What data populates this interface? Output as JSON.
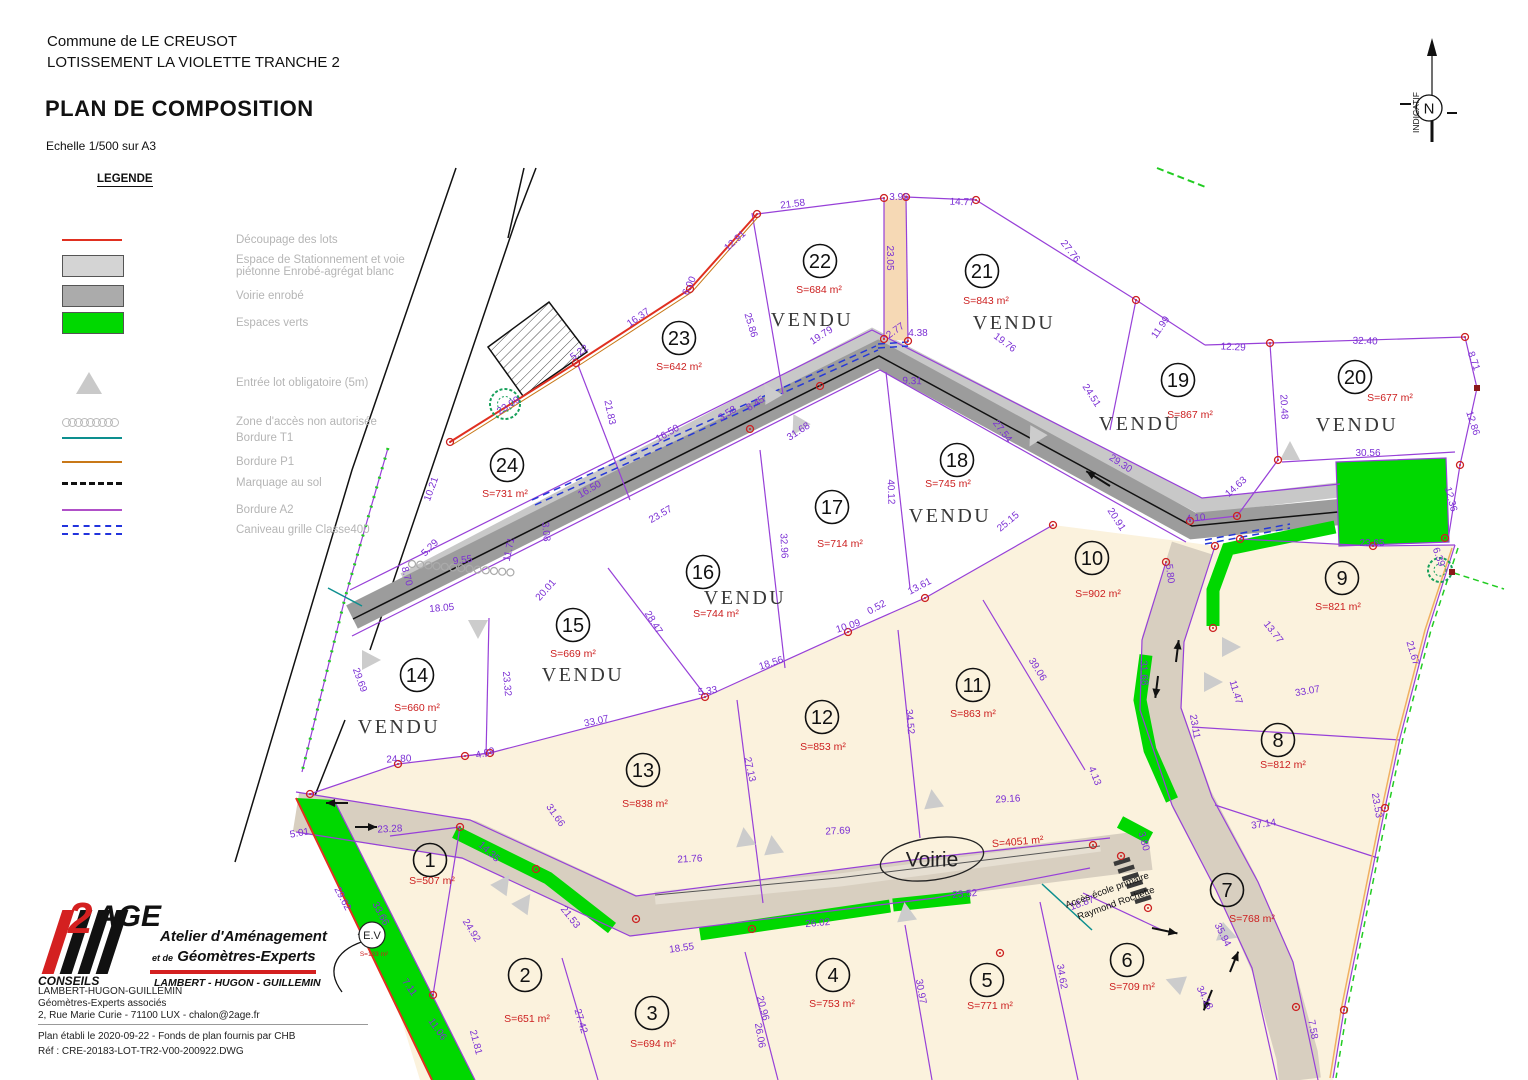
{
  "header": {
    "commune": "Commune de LE CREUSOT",
    "lotissement": "LOTISSEMENT LA VIOLETTE TRANCHE 2",
    "title": "PLAN DE COMPOSITION",
    "scale": "Echelle 1/500 sur A3"
  },
  "north": {
    "label": "INDICATIF",
    "n": "N"
  },
  "legend": {
    "title": "LEGENDE",
    "items": [
      {
        "type": "line-red",
        "color": "#e03020",
        "label": "Découpage des lots"
      },
      {
        "type": "box-light",
        "color": "#d4d4d4",
        "label": "Espace de Stationnement et voie",
        "label2": "piétonne Enrobé-agrégat blanc"
      },
      {
        "type": "box-gray",
        "color": "#ababab",
        "label": "Voirie enrobé"
      },
      {
        "type": "box-green",
        "color": "#00d800",
        "label": "Espaces verts"
      },
      {
        "type": "triangle",
        "color": "#c9c9c9",
        "label": "Entrée lot obligatoire (5m)"
      },
      {
        "type": "chain",
        "color": "#b9b9b9",
        "label": "Zone d'accès non autorisée"
      },
      {
        "type": "line-teal",
        "color": "#0d8f8f",
        "label": "Bordure T1"
      },
      {
        "type": "line-orange",
        "color": "#c87818",
        "label": "Bordure P1"
      },
      {
        "type": "dash-black",
        "color": "#111111",
        "label": "Marquage au sol"
      },
      {
        "type": "line-purple",
        "color": "#b050c8",
        "label": "Bordure A2"
      },
      {
        "type": "dash-blue",
        "color": "#2233dd",
        "label": "Caniveau grille Classe400"
      }
    ]
  },
  "map": {
    "lots": [
      {
        "num": "1",
        "area": "S=507 m²",
        "vendu": false,
        "cx": 430,
        "cy": 860,
        "ax": 432,
        "ay": 884
      },
      {
        "num": "2",
        "area": "S=651 m²",
        "vendu": false,
        "cx": 525,
        "cy": 975,
        "ax": 527,
        "ay": 1022
      },
      {
        "num": "3",
        "area": "S=694 m²",
        "vendu": false,
        "cx": 652,
        "cy": 1013,
        "ax": 653,
        "ay": 1047
      },
      {
        "num": "4",
        "area": "S=753 m²",
        "vendu": false,
        "cx": 833,
        "cy": 975,
        "ax": 832,
        "ay": 1007
      },
      {
        "num": "5",
        "area": "S=771 m²",
        "vendu": false,
        "cx": 987,
        "cy": 980,
        "ax": 990,
        "ay": 1009
      },
      {
        "num": "6",
        "area": "S=709 m²",
        "vendu": false,
        "cx": 1127,
        "cy": 960,
        "ax": 1132,
        "ay": 990
      },
      {
        "num": "7",
        "area": "S=768 m²",
        "vendu": false,
        "cx": 1227,
        "cy": 890,
        "ax": 1252,
        "ay": 922
      },
      {
        "num": "8",
        "area": "S=812 m²",
        "vendu": false,
        "cx": 1278,
        "cy": 740,
        "ax": 1283,
        "ay": 768
      },
      {
        "num": "9",
        "area": "S=821 m²",
        "vendu": false,
        "cx": 1342,
        "cy": 578,
        "ax": 1338,
        "ay": 610
      },
      {
        "num": "10",
        "area": "S=902 m²",
        "vendu": false,
        "cx": 1092,
        "cy": 558,
        "ax": 1098,
        "ay": 597
      },
      {
        "num": "11",
        "area": "S=863 m²",
        "vendu": false,
        "cx": 973,
        "cy": 685,
        "ax": 973,
        "ay": 717
      },
      {
        "num": "12",
        "area": "S=853 m²",
        "vendu": false,
        "cx": 822,
        "cy": 717,
        "ax": 823,
        "ay": 750
      },
      {
        "num": "13",
        "area": "S=838 m²",
        "vendu": false,
        "cx": 643,
        "cy": 770,
        "ax": 645,
        "ay": 807
      },
      {
        "num": "14",
        "area": "S=660 m²",
        "vendu": true,
        "cx": 417,
        "cy": 675,
        "ax": 417,
        "ay": 711,
        "vx": 399,
        "vy": 733
      },
      {
        "num": "15",
        "area": "S=669 m²",
        "vendu": true,
        "cx": 573,
        "cy": 625,
        "ax": 573,
        "ay": 657,
        "vx": 583,
        "vy": 681
      },
      {
        "num": "16",
        "area": "S=744 m²",
        "vendu": true,
        "cx": 703,
        "cy": 572,
        "ax": 716,
        "ay": 617,
        "vx": 745,
        "vy": 604
      },
      {
        "num": "17",
        "area": "S=714 m²",
        "vendu": false,
        "cx": 832,
        "cy": 507,
        "ax": 840,
        "ay": 547
      },
      {
        "num": "18",
        "area": "S=745 m²",
        "vendu": true,
        "cx": 957,
        "cy": 460,
        "ax": 948,
        "ay": 487,
        "vx": 950,
        "vy": 522
      },
      {
        "num": "19",
        "area": "S=867 m²",
        "vendu": true,
        "cx": 1178,
        "cy": 380,
        "ax": 1190,
        "ay": 418,
        "vx": 1140,
        "vy": 430
      },
      {
        "num": "20",
        "area": "S=677 m²",
        "vendu": true,
        "cx": 1355,
        "cy": 377,
        "ax": 1390,
        "ay": 401,
        "vx": 1357,
        "vy": 431
      },
      {
        "num": "21",
        "area": "S=843 m²",
        "vendu": true,
        "cx": 982,
        "cy": 271,
        "ax": 986,
        "ay": 304,
        "vx": 1014,
        "vy": 329
      },
      {
        "num": "22",
        "area": "S=684 m²",
        "vendu": true,
        "cx": 820,
        "cy": 261,
        "ax": 819,
        "ay": 293,
        "vx": 812,
        "vy": 326
      },
      {
        "num": "23",
        "area": "S=642 m²",
        "vendu": false,
        "cx": 679,
        "cy": 338,
        "ax": 679,
        "ay": 370
      },
      {
        "num": "24",
        "area": "S=731 m²",
        "vendu": false,
        "cx": 507,
        "cy": 465,
        "ax": 505,
        "ay": 497
      }
    ],
    "vendu_label": "VENDU",
    "dims": [
      {
        "t": "21.58",
        "x": 793,
        "y": 207,
        "r": -7
      },
      {
        "t": "3.96",
        "x": 899,
        "y": 200,
        "r": 0
      },
      {
        "t": "14.77",
        "x": 962,
        "y": 205,
        "r": 2
      },
      {
        "t": "23.05",
        "x": 887,
        "y": 258,
        "r": 90
      },
      {
        "t": "27.76",
        "x": 1068,
        "y": 253,
        "r": 52
      },
      {
        "t": "12.91",
        "x": 737,
        "y": 243,
        "r": -42
      },
      {
        "t": "6.00",
        "x": 692,
        "y": 287,
        "r": -65
      },
      {
        "t": "16.37",
        "x": 640,
        "y": 320,
        "r": -35
      },
      {
        "t": "25.86",
        "x": 748,
        "y": 326,
        "r": 73
      },
      {
        "t": "5.22",
        "x": 581,
        "y": 355,
        "r": -35
      },
      {
        "t": "23.09",
        "x": 510,
        "y": 408,
        "r": -33
      },
      {
        "t": "21.83",
        "x": 607,
        "y": 413,
        "r": 78
      },
      {
        "t": "2.77",
        "x": 897,
        "y": 333,
        "r": -35
      },
      {
        "t": "4.38",
        "x": 918,
        "y": 336,
        "r": 0
      },
      {
        "t": "19.79",
        "x": 823,
        "y": 338,
        "r": -33
      },
      {
        "t": "19.76",
        "x": 1003,
        "y": 345,
        "r": 37
      },
      {
        "t": "9.31",
        "x": 912,
        "y": 384,
        "r": 2
      },
      {
        "t": "24.51",
        "x": 1089,
        "y": 397,
        "r": 57
      },
      {
        "t": "11.99",
        "x": 1163,
        "y": 329,
        "r": -55
      },
      {
        "t": "12.29",
        "x": 1233,
        "y": 350,
        "r": 3
      },
      {
        "t": "32.40",
        "x": 1365,
        "y": 344,
        "r": 2
      },
      {
        "t": "8.71",
        "x": 1471,
        "y": 362,
        "r": 70
      },
      {
        "t": "20.48",
        "x": 1281,
        "y": 407,
        "r": 87
      },
      {
        "t": "12.86",
        "x": 1470,
        "y": 424,
        "r": 72
      },
      {
        "t": "30.56",
        "x": 1368,
        "y": 456,
        "r": 0
      },
      {
        "t": "12.36",
        "x": 1448,
        "y": 500,
        "r": 75
      },
      {
        "t": "23.65",
        "x": 1372,
        "y": 546,
        "r": 0
      },
      {
        "t": "27.54",
        "x": 1000,
        "y": 433,
        "r": 53
      },
      {
        "t": "40.12",
        "x": 888,
        "y": 492,
        "r": 88
      },
      {
        "t": "3.58",
        "x": 729,
        "y": 416,
        "r": -33
      },
      {
        "t": "8.45",
        "x": 757,
        "y": 406,
        "r": -33
      },
      {
        "t": "31.68",
        "x": 800,
        "y": 434,
        "r": -33
      },
      {
        "t": "16.50",
        "x": 669,
        "y": 436,
        "r": -30
      },
      {
        "t": "16.50",
        "x": 591,
        "y": 492,
        "r": -30
      },
      {
        "t": "23.57",
        "x": 662,
        "y": 517,
        "r": -30
      },
      {
        "t": "3.08",
        "x": 543,
        "y": 532,
        "r": 85
      },
      {
        "t": "11.71",
        "x": 512,
        "y": 550,
        "r": -78
      },
      {
        "t": "9.55",
        "x": 463,
        "y": 563,
        "r": -8
      },
      {
        "t": "5.29",
        "x": 432,
        "y": 550,
        "r": -45
      },
      {
        "t": "10.21",
        "x": 434,
        "y": 490,
        "r": -70
      },
      {
        "t": "29.30",
        "x": 1119,
        "y": 466,
        "r": 33
      },
      {
        "t": "20.91",
        "x": 1114,
        "y": 521,
        "r": 57
      },
      {
        "t": "4.10",
        "x": 1196,
        "y": 521,
        "r": -5
      },
      {
        "t": "14.63",
        "x": 1238,
        "y": 489,
        "r": -42
      },
      {
        "t": "5.80",
        "x": 1167,
        "y": 574,
        "r": 83
      },
      {
        "t": "13.77",
        "x": 1271,
        "y": 634,
        "r": 52
      },
      {
        "t": "11.47",
        "x": 1233,
        "y": 693,
        "r": 73
      },
      {
        "t": "31.68",
        "x": 1141,
        "y": 673,
        "r": 87
      },
      {
        "t": "25.15",
        "x": 1010,
        "y": 524,
        "r": -40
      },
      {
        "t": "13.61",
        "x": 921,
        "y": 589,
        "r": -28
      },
      {
        "t": "0.52",
        "x": 878,
        "y": 610,
        "r": -28
      },
      {
        "t": "10.09",
        "x": 849,
        "y": 629,
        "r": -18
      },
      {
        "t": "20.01",
        "x": 548,
        "y": 592,
        "r": -48
      },
      {
        "t": "18.05",
        "x": 442,
        "y": 611,
        "r": -5
      },
      {
        "t": "28.47",
        "x": 651,
        "y": 624,
        "r": 58
      },
      {
        "t": "23.32",
        "x": 504,
        "y": 684,
        "r": 85
      },
      {
        "t": "29.69",
        "x": 357,
        "y": 681,
        "r": 70
      },
      {
        "t": "8.70",
        "x": 404,
        "y": 577,
        "r": 75
      },
      {
        "t": "32.96",
        "x": 781,
        "y": 546,
        "r": 87
      },
      {
        "t": "5.33",
        "x": 708,
        "y": 694,
        "r": -8
      },
      {
        "t": "33.07",
        "x": 597,
        "y": 724,
        "r": -12
      },
      {
        "t": "24.80",
        "x": 399,
        "y": 762,
        "r": -3
      },
      {
        "t": "4.69",
        "x": 486,
        "y": 756,
        "r": -15
      },
      {
        "t": "27.13",
        "x": 747,
        "y": 770,
        "r": 78
      },
      {
        "t": "31.66",
        "x": 553,
        "y": 817,
        "r": 55
      },
      {
        "t": "23.28",
        "x": 390,
        "y": 832,
        "r": -3
      },
      {
        "t": "18.56",
        "x": 772,
        "y": 666,
        "r": -18
      },
      {
        "t": "34.52",
        "x": 907,
        "y": 722,
        "r": 85
      },
      {
        "t": "39.06",
        "x": 1035,
        "y": 671,
        "r": 58
      },
      {
        "t": "27.69",
        "x": 838,
        "y": 834,
        "r": -3
      },
      {
        "t": "29.16",
        "x": 1008,
        "y": 802,
        "r": -3
      },
      {
        "t": "4.13",
        "x": 1092,
        "y": 777,
        "r": 68
      },
      {
        "t": "33.07",
        "x": 1308,
        "y": 694,
        "r": -10
      },
      {
        "t": "23.11",
        "x": 1192,
        "y": 727,
        "r": 80
      },
      {
        "t": "37.14",
        "x": 1264,
        "y": 827,
        "r": -8
      },
      {
        "t": "21.67",
        "x": 1410,
        "y": 654,
        "r": 73
      },
      {
        "t": "23.53",
        "x": 1374,
        "y": 806,
        "r": 80
      },
      {
        "t": "6.39",
        "x": 1436,
        "y": 558,
        "r": 70
      },
      {
        "t": "14.35",
        "x": 487,
        "y": 854,
        "r": 42
      },
      {
        "t": "21.76",
        "x": 690,
        "y": 862,
        "r": -3
      },
      {
        "t": "24.92",
        "x": 469,
        "y": 932,
        "r": 58
      },
      {
        "t": "21.53",
        "x": 568,
        "y": 919,
        "r": 52
      },
      {
        "t": "18.55",
        "x": 682,
        "y": 951,
        "r": -8
      },
      {
        "t": "20.96",
        "x": 760,
        "y": 1009,
        "r": 75
      },
      {
        "t": "27.42",
        "x": 578,
        "y": 1022,
        "r": 73
      },
      {
        "t": "7.11",
        "x": 407,
        "y": 989,
        "r": 55
      },
      {
        "t": "11.06",
        "x": 435,
        "y": 1031,
        "r": 55
      },
      {
        "t": "21.81",
        "x": 473,
        "y": 1043,
        "r": 75
      },
      {
        "t": "23.52",
        "x": 965,
        "y": 897,
        "r": -5
      },
      {
        "t": "26.02",
        "x": 818,
        "y": 926,
        "r": -5
      },
      {
        "t": "18.87",
        "x": 1083,
        "y": 906,
        "r": -20
      },
      {
        "t": "30.97",
        "x": 918,
        "y": 992,
        "r": 80
      },
      {
        "t": "34.62",
        "x": 1059,
        "y": 977,
        "r": 80
      },
      {
        "t": "35.94",
        "x": 1220,
        "y": 936,
        "r": 63
      },
      {
        "t": "34.18",
        "x": 1202,
        "y": 999,
        "r": 63
      },
      {
        "t": "3.80",
        "x": 1141,
        "y": 842,
        "r": 75
      },
      {
        "t": "5.01",
        "x": 300,
        "y": 836,
        "r": -10
      },
      {
        "t": "29.62",
        "x": 340,
        "y": 900,
        "r": 62
      },
      {
        "t": "33.66",
        "x": 378,
        "y": 915,
        "r": 62
      },
      {
        "t": "7.58",
        "x": 1310,
        "y": 1030,
        "r": 80
      },
      {
        "t": "26.06",
        "x": 757,
        "y": 1036,
        "r": 80
      }
    ],
    "labels": {
      "voirie": "Voirie",
      "voirie_area": "S=4051 m²",
      "acces_line1": "Accès école primaire",
      "acces_line2": "Raymond Rochette",
      "ev": "E.V",
      "ev_area": "S=133 m²"
    },
    "colors": {
      "dim": "#7b2fd4",
      "area": "#cc2020",
      "boundary": "#9740d8",
      "cream": "#fbf2dd",
      "road_gray": "#9c9c9c",
      "road_light": "#c8c8c8",
      "road_tan": "#d8cfc0",
      "green": "#00d800",
      "red": "#e03020",
      "orange": "#c87818",
      "teal": "#0d8f8f",
      "blue": "#2538d8",
      "peach": "#f6d9b5"
    }
  },
  "footer": {
    "logo": {
      "two": "2",
      "age": "AGE",
      "line1": "Atelier d'Aménagement",
      "line2_small": "et de",
      "line2": "Géomètres-Experts",
      "conseils": "CONSEILS",
      "partners": "LAMBERT - HUGON - GUILLEMIN"
    },
    "address": [
      "LAMBERT-HUGON-GUILLEMIN",
      "Géomètres-Experts associés",
      "2, Rue Marie Curie - 71100 LUX - chalon@2age.fr"
    ],
    "note1": "Plan établi le 2020-09-22 - Fonds de plan fournis par CHB",
    "note2": "Réf : CRE-20183-LOT-TR2-V00-200922.DWG"
  }
}
